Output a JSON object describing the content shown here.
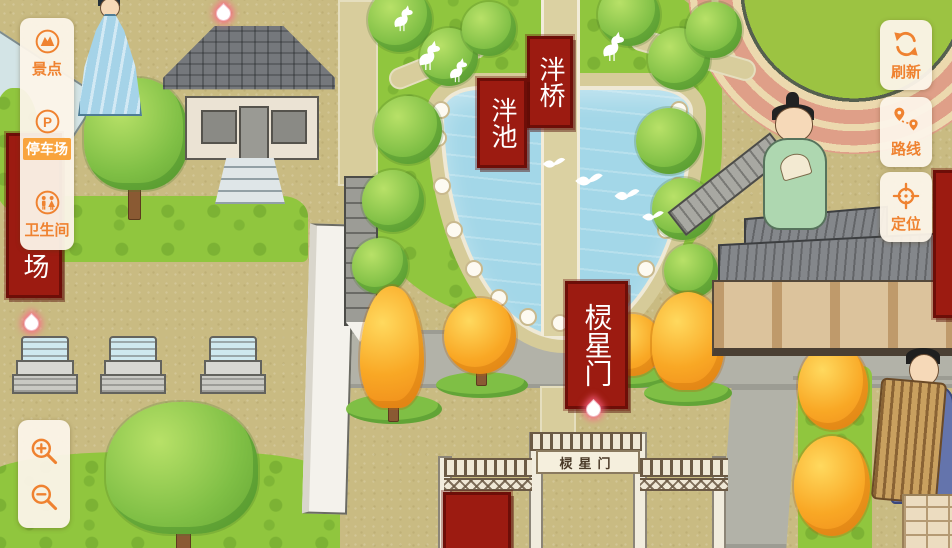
{
  "left_panel": {
    "items": [
      {
        "id": "scenic-spots",
        "icon": "scenic-spot-icon",
        "label": "景点",
        "selected": false
      },
      {
        "id": "parking",
        "icon": "parking-icon",
        "label": "停车场",
        "selected": true
      },
      {
        "id": "restroom",
        "icon": "restroom-icon",
        "label": "卫生间",
        "selected": false
      }
    ]
  },
  "right_panel": {
    "buttons": [
      {
        "id": "refresh",
        "icon": "refresh-icon",
        "label": "刷新"
      },
      {
        "id": "route",
        "icon": "route-icon",
        "label": "路线"
      },
      {
        "id": "locate",
        "icon": "locate-icon",
        "label": "定位"
      }
    ]
  },
  "zoom_controls": {
    "buttons": [
      {
        "id": "zoom-in",
        "icon": "zoom-in-icon"
      },
      {
        "id": "zoom-out",
        "icon": "zoom-out-icon"
      }
    ]
  },
  "map": {
    "labels": {
      "pan_bridge_banner": "泮桥",
      "pan_pond_banner": "泮池",
      "lingxing_gate_banner": "棂星门",
      "lingxing_gate_sign": "棂星门",
      "left_edge_banner_visible_text": "场"
    },
    "colors": {
      "accent_orange": "#ef8230",
      "selected_item_bg": "#f9a43d",
      "panel_cream": "#fcf4e9",
      "banner_red": "#9c1b11",
      "water_blue": "#a3d7e8",
      "lawn_green": "#90c63e",
      "ground_tan": "#c9bb82",
      "road_gray": "#b2b2a8"
    }
  }
}
